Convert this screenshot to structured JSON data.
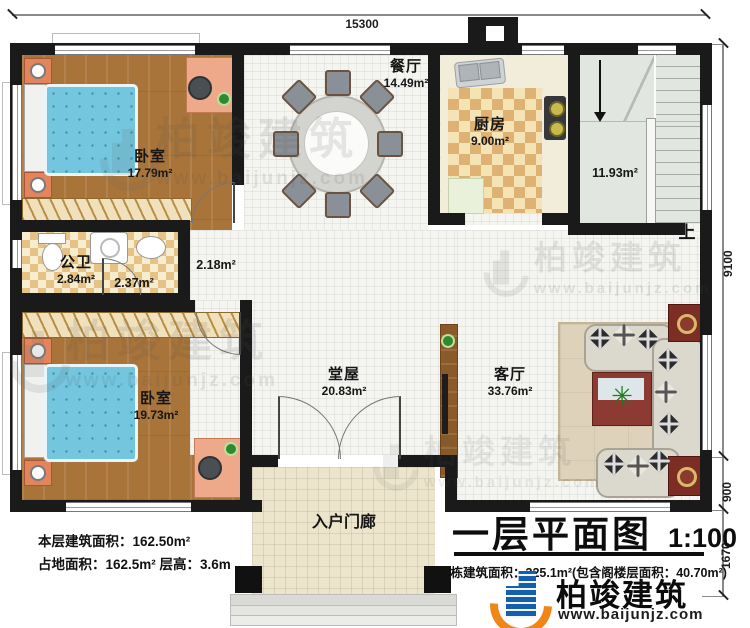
{
  "dims": {
    "top": "15300",
    "right_main": "9100",
    "right_mid": "900",
    "right_bottom": "1670"
  },
  "rooms": {
    "bedroom1": {
      "name": "卧室",
      "area": "17.79m²"
    },
    "bathroom": {
      "name": "公卫",
      "area": "2.84m²"
    },
    "bath_side_area": "2.37m²",
    "hallway_area": "2.18m²",
    "bedroom2": {
      "name": "卧室",
      "area": "19.73m²"
    },
    "dining": {
      "name": "餐厅",
      "area": "14.49m²"
    },
    "kitchen": {
      "name": "厨房",
      "area": "9.00m²"
    },
    "stairwell": {
      "area": "11.93m²",
      "up_label": "上"
    },
    "central_hall": {
      "name": "堂屋",
      "area": "20.83m²"
    },
    "living": {
      "name": "客厅",
      "area": "33.76m²"
    },
    "porch": {
      "name": "入户门廊"
    }
  },
  "notes_left": {
    "line1": "本层建筑面积：162.50m²",
    "line2": "占地面积：162.5m² 层高：3.6m"
  },
  "title": {
    "name": "一层平面图",
    "scale": "1:100",
    "note": "本栋建筑面积：325.1m²(包含阁楼层面积：40.70m²)"
  },
  "brand": {
    "name": "柏竣建筑",
    "url": "www.baijunjz.com"
  },
  "watermark": {
    "name": "柏竣建筑",
    "url": "www.baijunjz.com"
  },
  "icons": {
    "plant_icon": "✳"
  },
  "colors": {
    "wall": "#1a1a1a",
    "wood": "#a8743a",
    "bed": "#74c6de",
    "bath_tile": "#e6c285",
    "brand_blue": "#1460ae",
    "brand_orange": "#f08519"
  }
}
